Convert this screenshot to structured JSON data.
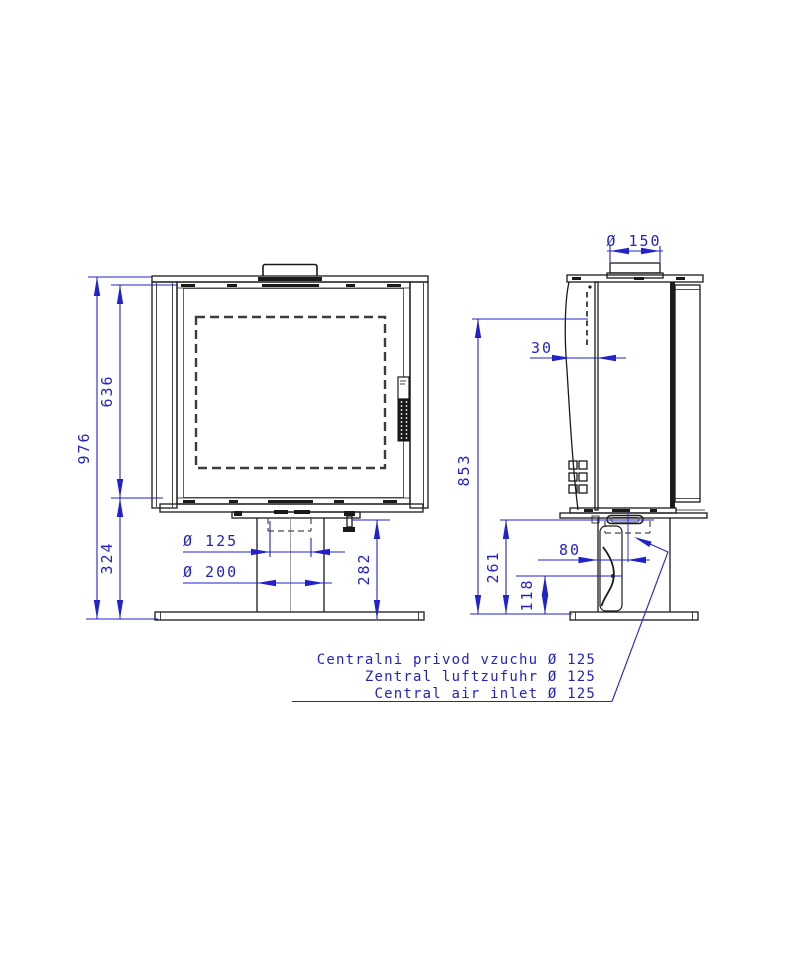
{
  "colors": {
    "dimension_blue": "#2222cc",
    "linework_black": "#1a1a1a"
  },
  "dimensions": {
    "front": {
      "overall_height": "976",
      "firebox_height": "636",
      "pedestal_height": "324",
      "air_inlet_diameter": "Ø 125",
      "pedestal_tube_diameter": "Ø 200",
      "pedestal_section_height": "282"
    },
    "side": {
      "flue_diameter": "Ø 150",
      "rear_gap": "30",
      "rear_outlet_height": "853",
      "inlet_section_height": "261",
      "duct_joint_height": "118",
      "inlet_center_offset": "80"
    }
  },
  "notes": {
    "czech": "Centralni privod vzuchu Ø 125",
    "german": "Zentral luftzufuhr Ø 125",
    "english": "Central air inlet Ø 125"
  }
}
